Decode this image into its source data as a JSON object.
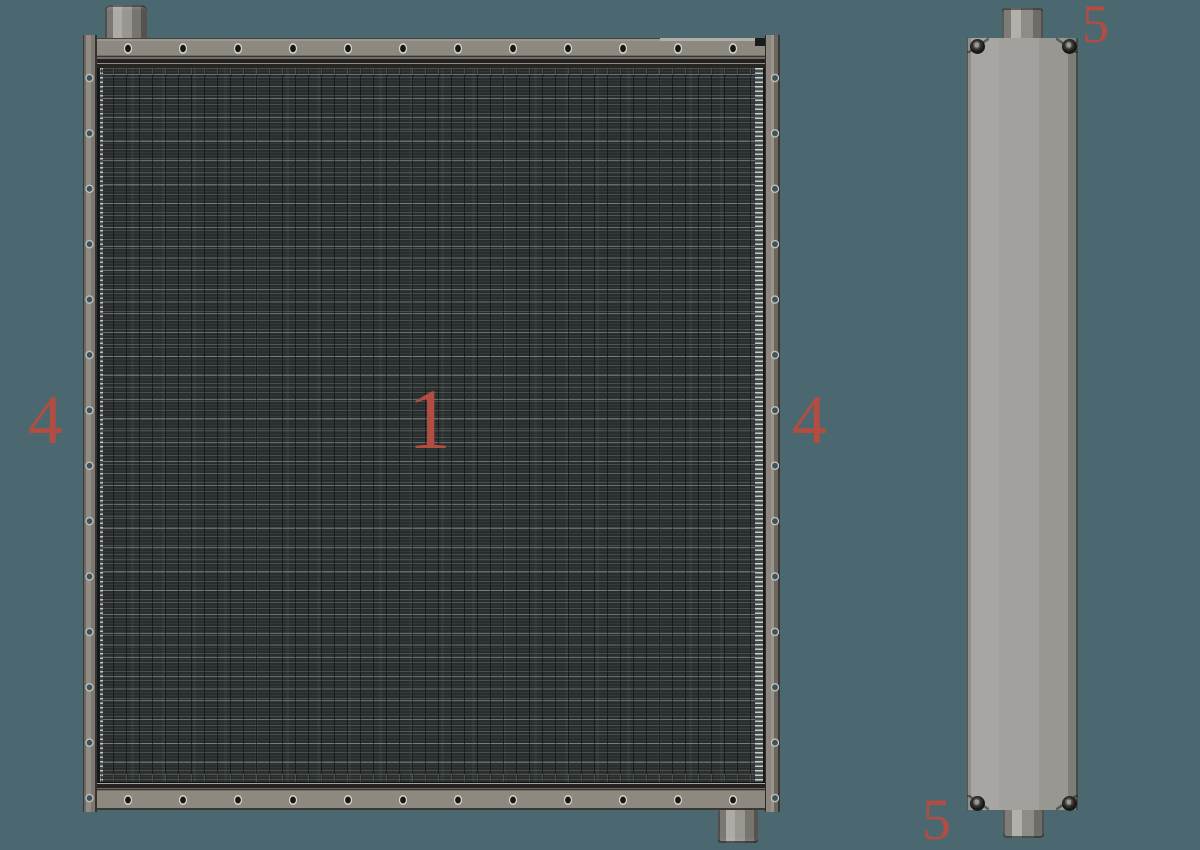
{
  "background_color": "#4b6770",
  "callout_color": "#b34d42",
  "callouts": [
    {
      "part": "core",
      "label": "1"
    },
    {
      "part": "left-side-channel",
      "label": "4"
    },
    {
      "part": "right-side-channel",
      "label": "4"
    },
    {
      "part": "collector-tank-top",
      "label": "5"
    },
    {
      "part": "collector-tank-bottom",
      "label": "5"
    }
  ],
  "colors": {
    "frame_gray": "#8d8981",
    "core_base": "#292d2e",
    "core_fin_highlight": "#5b6a6a",
    "tank_gray": "#9a9995",
    "fitting_gray": "#9b9892",
    "hole_inner": "#3c535b"
  }
}
